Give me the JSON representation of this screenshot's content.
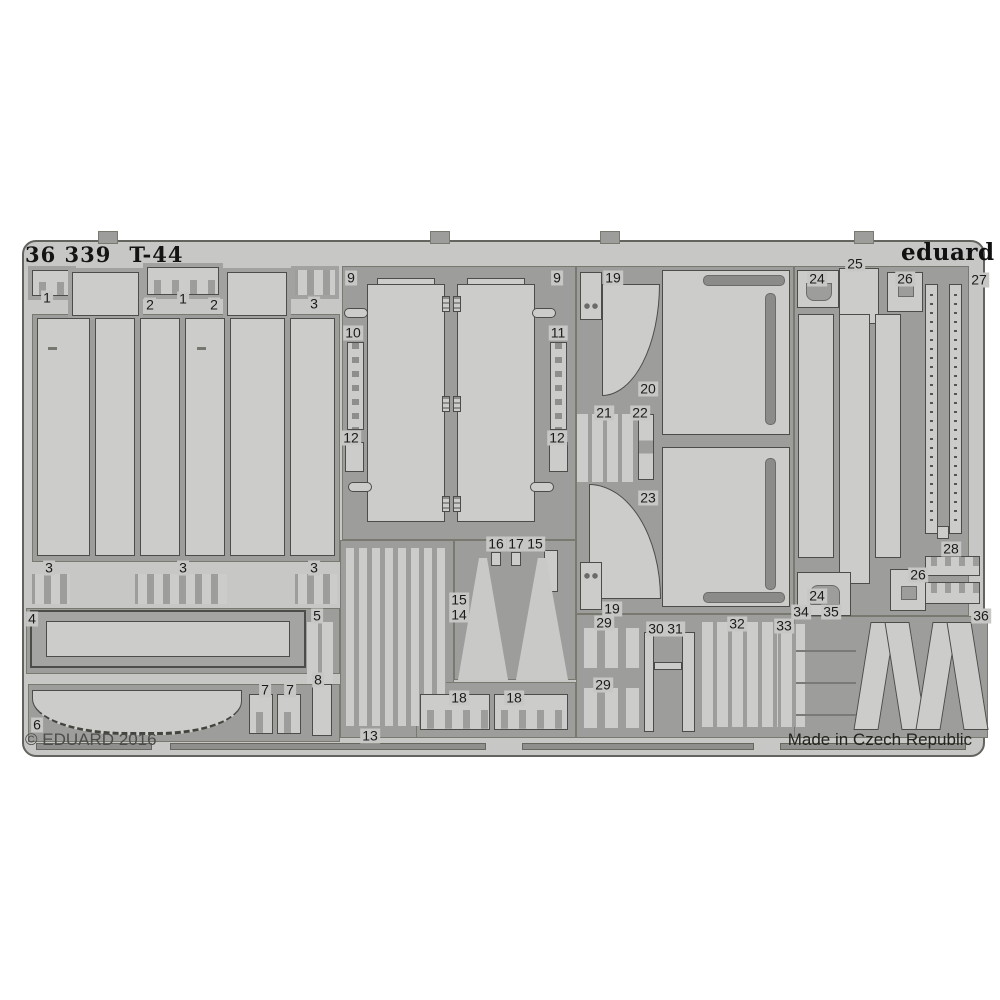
{
  "product": {
    "catalog_number": "36 339",
    "subject": "T-44",
    "brand": "eduard",
    "copyright": "© EDUARD 2016",
    "made_in": "Made in Czech Republic"
  },
  "colors": {
    "background": "#ffffff",
    "sheet_metal": "#c7c7c5",
    "etched_area": "#9d9d9b",
    "part_fill": "#cccccb",
    "outline": "#4c4c48",
    "text": "#1b1b19",
    "muted_text": "#50504c"
  },
  "part_labels": [
    {
      "n": "1",
      "x": 23,
      "y": 56
    },
    {
      "n": "2",
      "x": 126,
      "y": 63
    },
    {
      "n": "1",
      "x": 159,
      "y": 57
    },
    {
      "n": "2",
      "x": 190,
      "y": 63
    },
    {
      "n": "3",
      "x": 290,
      "y": 62
    },
    {
      "n": "3",
      "x": 25,
      "y": 326
    },
    {
      "n": "3",
      "x": 159,
      "y": 326
    },
    {
      "n": "3",
      "x": 290,
      "y": 326
    },
    {
      "n": "4",
      "x": 8,
      "y": 377
    },
    {
      "n": "5",
      "x": 293,
      "y": 374
    },
    {
      "n": "8",
      "x": 294,
      "y": 438
    },
    {
      "n": "7",
      "x": 241,
      "y": 448
    },
    {
      "n": "7",
      "x": 266,
      "y": 448
    },
    {
      "n": "6",
      "x": 13,
      "y": 483
    },
    {
      "n": "9",
      "x": 327,
      "y": 36
    },
    {
      "n": "9",
      "x": 533,
      "y": 36
    },
    {
      "n": "10",
      "x": 329,
      "y": 91
    },
    {
      "n": "11",
      "x": 534,
      "y": 91
    },
    {
      "n": "12",
      "x": 327,
      "y": 196
    },
    {
      "n": "12",
      "x": 533,
      "y": 196
    },
    {
      "n": "16",
      "x": 472,
      "y": 302
    },
    {
      "n": "17",
      "x": 492,
      "y": 302
    },
    {
      "n": "15",
      "x": 511,
      "y": 302
    },
    {
      "n": "15",
      "x": 435,
      "y": 358
    },
    {
      "n": "14",
      "x": 435,
      "y": 373
    },
    {
      "n": "18",
      "x": 435,
      "y": 456
    },
    {
      "n": "18",
      "x": 490,
      "y": 456
    },
    {
      "n": "13",
      "x": 346,
      "y": 494
    },
    {
      "n": "19",
      "x": 589,
      "y": 36
    },
    {
      "n": "20",
      "x": 624,
      "y": 147
    },
    {
      "n": "21",
      "x": 580,
      "y": 171
    },
    {
      "n": "22",
      "x": 616,
      "y": 171
    },
    {
      "n": "23",
      "x": 624,
      "y": 256
    },
    {
      "n": "19",
      "x": 588,
      "y": 367
    },
    {
      "n": "29",
      "x": 580,
      "y": 381
    },
    {
      "n": "29",
      "x": 579,
      "y": 443
    },
    {
      "n": "30",
      "x": 632,
      "y": 387
    },
    {
      "n": "31",
      "x": 651,
      "y": 387
    },
    {
      "n": "32",
      "x": 713,
      "y": 382
    },
    {
      "n": "33",
      "x": 760,
      "y": 384
    },
    {
      "n": "25",
      "x": 831,
      "y": 22
    },
    {
      "n": "24",
      "x": 793,
      "y": 37
    },
    {
      "n": "26",
      "x": 881,
      "y": 37
    },
    {
      "n": "27",
      "x": 955,
      "y": 38
    },
    {
      "n": "28",
      "x": 927,
      "y": 307
    },
    {
      "n": "26",
      "x": 894,
      "y": 333
    },
    {
      "n": "24",
      "x": 793,
      "y": 354
    },
    {
      "n": "34",
      "x": 777,
      "y": 370
    },
    {
      "n": "35",
      "x": 807,
      "y": 370
    },
    {
      "n": "36",
      "x": 957,
      "y": 374
    }
  ]
}
